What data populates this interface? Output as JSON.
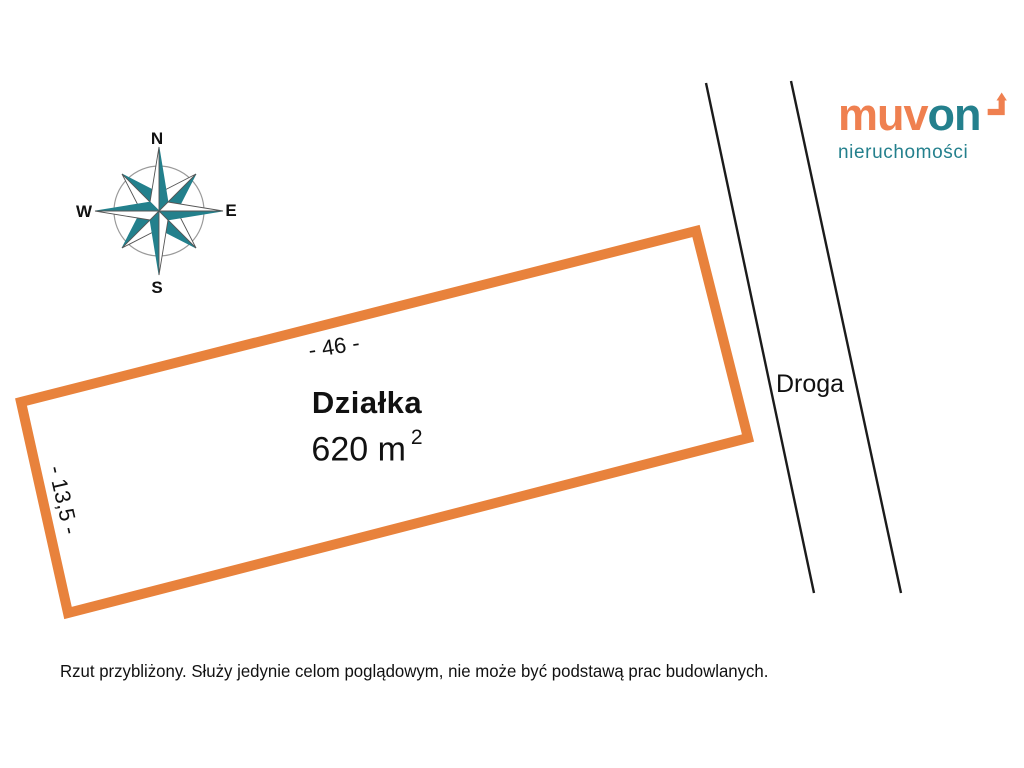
{
  "colors": {
    "plot_outline_orange": "#E8823C",
    "brand_orange": "#EF8050",
    "brand_teal": "#24808D",
    "road_line_black": "#1b1b1b",
    "compass_teal": "#23808C"
  },
  "compass": {
    "icon": "compass-rose-icon",
    "labels": {
      "north": "N",
      "east": "E",
      "south": "S",
      "west": "W"
    }
  },
  "plot": {
    "title": "Działka",
    "area_value": "620 m",
    "area_exponent": "2",
    "top_dimension": "- 46 -",
    "left_dimension": "- 13,5 -"
  },
  "road": {
    "label": "Droga"
  },
  "logo": {
    "word_part_orange": "muv",
    "word_part_teal": "on",
    "subtitle": "nieruchomości",
    "arrow_icon": "bent-arrow-up-right-icon"
  },
  "disclaimer": "Rzut przybliżony. Służy jedynie celom poglądowym, nie może być podstawą prac budowlanych."
}
